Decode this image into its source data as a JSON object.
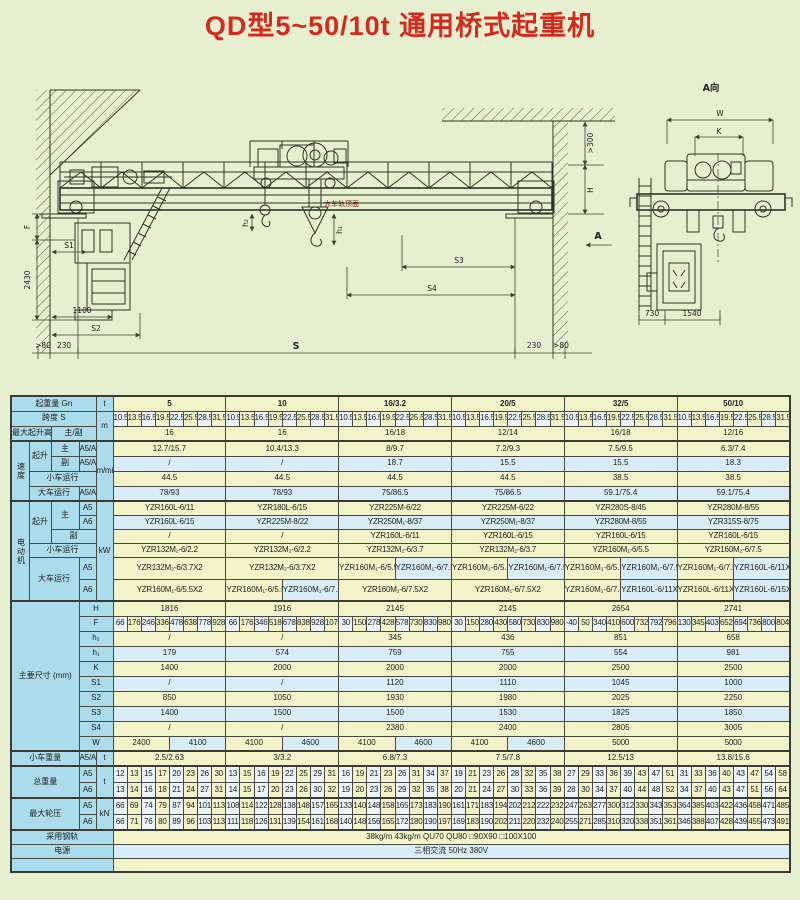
{
  "title": "QD型5~50/10t 通用桥式起重机",
  "drawing": {
    "main": {
      "dim_f": "F",
      "dim_2430": "2430",
      "dim_s1": "S1",
      "dim_1100": "1100",
      "dim_s2": "S2",
      "dim_gt80_left": ">80",
      "dim_230_left": "230",
      "dim_span": "S",
      "dim_s3": "S3",
      "dim_s4": "S4",
      "dim_230_right": "230",
      "dim_gt80_right": ">80",
      "dim_gt300": ">300",
      "dim_h": "H",
      "view_arrow": "A",
      "rail_top_note": "大车轨顶面",
      "dim_h2": "h₂",
      "dim_h1": "h₁"
    },
    "side": {
      "view_title": "A向",
      "dim_w": "W",
      "dim_k": "K",
      "dim_730": "730",
      "dim_1540": "1540"
    }
  },
  "table": {
    "labels": {
      "capacity": "起重量 Gn",
      "unit_t": "t",
      "span": "跨度 S",
      "unit_m": "m",
      "lift_height": "最大起升高度",
      "main_aux": "主/副",
      "speed": "速度",
      "unit_mmin": "m/min",
      "hoist": "起升",
      "main": "主",
      "aux": "副",
      "a5a6": "A5/A6",
      "a5": "A5",
      "a6": "A6",
      "trolley_travel": "小车运行",
      "crane_travel": "大车运行",
      "motor": "电动机",
      "unit_kw": "kW",
      "dims": "主要尺寸",
      "dims_unit": "(mm)",
      "dim_H": "H",
      "dim_F": "F",
      "dim_h2": "h₂",
      "dim_h1": "h₁",
      "dim_K": "K",
      "dim_S1": "S1",
      "dim_S2": "S2",
      "dim_S3": "S3",
      "dim_S4": "S4",
      "dim_W": "W",
      "trolley_weight": "小车重量",
      "total_weight": "总重量",
      "wheel_load": "最大轮压",
      "unit_kn": "kN",
      "rail": "采用钢轨",
      "power": "电源"
    },
    "capacities": [
      "5",
      "10",
      "16/3.2",
      "20/5",
      "32/5",
      "50/10"
    ],
    "spans": [
      "10.5",
      "13.5",
      "16.5",
      "19.5",
      "22.5",
      "25.5",
      "28.5",
      "31.5"
    ],
    "lift_heights": [
      "16",
      "16",
      "16/18",
      "12/14",
      "16/18",
      "12/16"
    ],
    "speed_hoist_main": [
      "12.7/15.7",
      "10.4/13.3",
      "8/9.7",
      "7.2/9.3",
      "7.5/9.5",
      "6.3/7.4"
    ],
    "speed_hoist_aux": [
      "/",
      "/",
      "18.7",
      "15.5",
      "15.5",
      "18.3"
    ],
    "speed_trolley": [
      "44.5",
      "44.5",
      "44.5",
      "44.5",
      "38.5",
      "38.5"
    ],
    "speed_crane": [
      "78/93",
      "78/93",
      "75/86.5",
      "75/86.5",
      "59.1/75.4",
      "59.1/75.4"
    ],
    "motor_hoist_main_a5": [
      "YZR160L-6/11",
      "YZR180L-6/15",
      "YZR225M-6/22",
      "YZR225M-6/22",
      "YZR280S-8/45",
      "YZR280M-8/55"
    ],
    "motor_hoist_main_a6": [
      "YZR160L-6/15",
      "YZR225M-8/22",
      "YZR250M₁-8/37",
      "YZR250M₁-8/37",
      "YZR280M-8/55",
      "YZR315S-8/75"
    ],
    "motor_hoist_aux": [
      "/",
      "/",
      "YZR160L-6/11",
      "YZR160L-6/15",
      "YZR160L-6/15",
      "YZR160L-6/15"
    ],
    "motor_trolley": [
      "YZR132M₂-6/2.2",
      "YZR132M₂-6/2.2",
      "YZR132M₂-6/3.7",
      "YZR132M₂-6/3.7",
      "YZR160M₁-6/5.5",
      "YZR160M₂-6/7.5"
    ],
    "motor_crane_a5": [
      [
        "YZR132M₂-6/3.7X2"
      ],
      [
        "YZR132M₂-6/3.7X2"
      ],
      [
        "YZR160M₁-6/5.5X2",
        "YZR160M₁-6/7.5X2"
      ],
      [
        "YZR160M₁-6/5.5X2",
        "YZR160M₁-6/7.5X2"
      ],
      [
        "YZR160M₁-6/5.5X2",
        "YZR160M₁-6/7.5X2"
      ],
      [
        "YZR160M₁-6/7.5X2",
        "YZR160L-6/11X2"
      ]
    ],
    "motor_crane_a6": [
      [
        "YZR160M₁-6/5.5X2"
      ],
      [
        "YZR160M₁-6/5.5X2",
        "YZR160M₁-6/7.5X2"
      ],
      [
        "YZR160M₁-6/7.5X2"
      ],
      [
        "YZR160M₁-6/7.5X2"
      ],
      [
        "YZR160M₁-6/7.5X2",
        "YZR160L-6/11X2"
      ],
      [
        "YZR160L-6/11X2",
        "YZR160L-6/15X2"
      ]
    ],
    "dims": {
      "H": [
        "1816",
        "1916",
        "2145",
        "2145",
        "2654",
        "2741"
      ],
      "F": [
        [
          "66",
          "176",
          "246",
          "336",
          "478",
          "638",
          "778",
          "928"
        ],
        [
          "66",
          "176",
          "346",
          "518",
          "678",
          "838",
          "928",
          "1078"
        ],
        [
          "30",
          "150",
          "278",
          "428",
          "578",
          "730",
          "830",
          "980"
        ],
        [
          "30",
          "150",
          "280",
          "430",
          "580",
          "730",
          "830",
          "980"
        ],
        [
          "-40",
          "50",
          "340",
          "410",
          "600",
          "732",
          "792",
          "796"
        ],
        [
          "130",
          "345",
          "403",
          "652",
          "694",
          "736",
          "800",
          "804"
        ]
      ],
      "h2": [
        "/",
        "/",
        "345",
        "436",
        "851",
        "658"
      ],
      "h1": [
        "179",
        "574",
        "759",
        "755",
        "554",
        "981"
      ],
      "K": [
        "1400",
        "2000",
        "2000",
        "2000",
        "2500",
        "2500"
      ],
      "S1": [
        "/",
        "/",
        "1120",
        "1110",
        "1045",
        "1000"
      ],
      "S2": [
        "850",
        "1050",
        "1930",
        "1980",
        "2025",
        "2250"
      ],
      "S3": [
        "1400",
        "1500",
        "1500",
        "1530",
        "1825",
        "1850"
      ],
      "S4": [
        "/",
        "/",
        "2380",
        "2400",
        "2805",
        "3005"
      ],
      "W": [
        [
          "2400",
          "4100"
        ],
        [
          "4100",
          "4600"
        ],
        [
          "4100",
          "4600"
        ],
        [
          "4100",
          "4600"
        ],
        [
          "5000"
        ],
        [
          "5000"
        ]
      ]
    },
    "trolley_weight": [
      "2.5/2.63",
      "3/3.2",
      "6.8/7.3",
      "7.5/7.8",
      "12.5/13",
      "13.8/15.6"
    ],
    "total_weight_a5": [
      [
        12,
        13,
        15,
        17,
        20,
        23,
        26,
        30
      ],
      [
        13,
        15,
        16,
        19,
        22,
        25,
        29,
        31
      ],
      [
        16,
        19,
        21,
        23,
        26,
        31,
        34,
        37
      ],
      [
        19,
        21,
        23,
        26,
        28,
        32,
        35,
        38
      ],
      [
        27,
        29,
        33,
        36,
        39,
        43,
        47,
        51
      ],
      [
        31,
        33,
        36,
        40,
        43,
        47,
        54,
        58
      ]
    ],
    "total_weight_a6": [
      [
        13,
        14,
        16,
        18,
        21,
        24,
        27,
        31
      ],
      [
        14,
        15,
        17,
        20,
        23,
        26,
        30,
        32
      ],
      [
        19,
        20,
        23,
        26,
        29,
        32,
        35,
        38
      ],
      [
        20,
        21,
        24,
        27,
        30,
        33,
        36,
        39
      ],
      [
        28,
        30,
        34,
        37,
        40,
        44,
        48,
        52
      ],
      [
        34,
        37,
        40,
        43,
        47,
        51,
        56,
        64
      ]
    ],
    "wheel_load_a5": [
      [
        66,
        69,
        74,
        79,
        87,
        94,
        101,
        113
      ],
      [
        108,
        114,
        122,
        128,
        138,
        148,
        157,
        165
      ],
      [
        133,
        140,
        148,
        158,
        165,
        173,
        183,
        190
      ],
      [
        161,
        171,
        183,
        194,
        202,
        212,
        222,
        232
      ],
      [
        247,
        263,
        277,
        300,
        312,
        330,
        343,
        353
      ],
      [
        364,
        385,
        403,
        422,
        436,
        458,
        471,
        485
      ]
    ],
    "wheel_load_a6": [
      [
        66,
        71,
        76,
        80,
        89,
        96,
        103,
        113
      ],
      [
        111,
        118,
        126,
        131,
        139,
        154,
        161,
        168
      ],
      [
        140,
        148,
        156,
        165,
        172,
        180,
        190,
        197
      ],
      [
        169,
        183,
        190,
        202,
        211,
        220,
        232,
        240
      ],
      [
        255,
        271,
        285,
        310,
        320,
        338,
        351,
        361
      ],
      [
        346,
        388,
        407,
        428,
        439,
        455,
        473,
        491
      ]
    ],
    "rail_value": "38kg/m   43kg/m   QU70   QU80   □90X90   □100X100",
    "power_value": "三相交流   50Hz   380V",
    "empty_value": ""
  }
}
